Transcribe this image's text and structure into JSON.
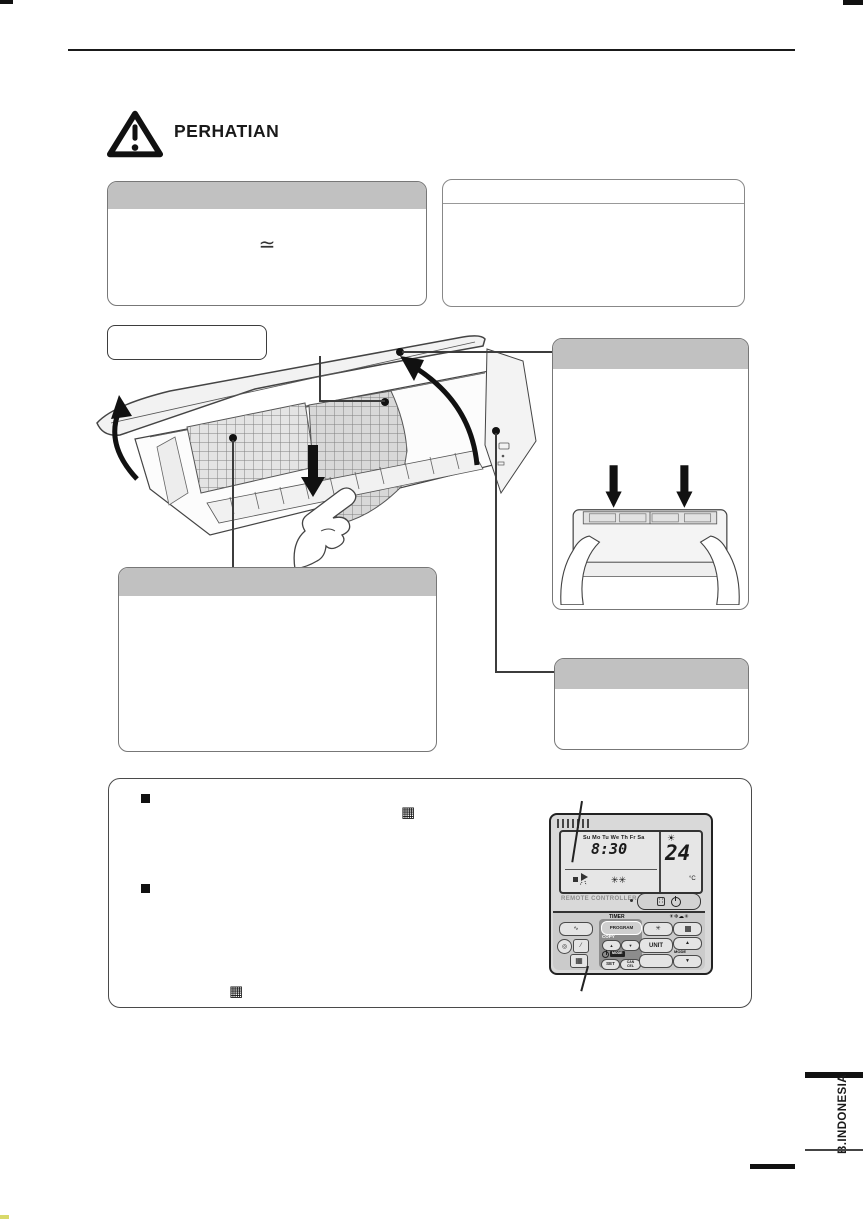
{
  "page": {
    "caution_label": "PERHATIAN",
    "language_tab_label": "B.INDONESIA",
    "ac_power_symbol": "≃"
  },
  "remote": {
    "name_label": "REMOTE CONTROLLER",
    "lcd": {
      "days": "Su Mo Tu We Th Fr Sa",
      "time": "8:30",
      "temperature": "24",
      "temperature_unit": "°C"
    },
    "buttons": {
      "timer_section_label": "TIMER",
      "program_label": "PROGRAM",
      "copy_label": "COPY",
      "set_label": "SET",
      "cancel_label": "CAN CEL",
      "unit_label": "UNIT",
      "mode_label": "MODE"
    }
  },
  "icons": {
    "bullet_square": "■",
    "filter_grid": "▦",
    "up_arrow": "▲",
    "down_arrow": "▼",
    "fan_asterisk": "✳",
    "mode_icon_row": "☀❄☁✳",
    "lcd_status_icons": "✳✳",
    "lcd_mode_icon": "☀",
    "wave": "∿",
    "circle_target": "◎",
    "slash": "⁄",
    "proportion": "∷"
  },
  "colors": {
    "section_header_gray": "#c1c1c1",
    "ink_black": "#1a1a1a",
    "remote_body_gray": "#d9d9d9",
    "lcd_gray": "#e6e6e6"
  }
}
